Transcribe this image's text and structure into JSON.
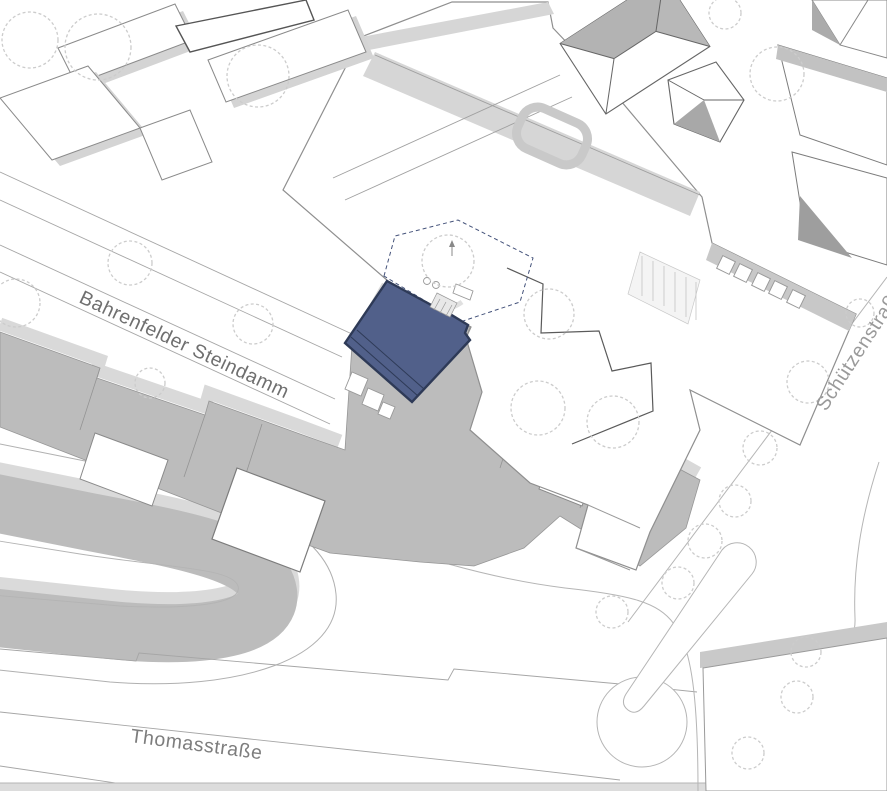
{
  "plan": {
    "type": "architectural-site-plan",
    "labels": {
      "street_upper": "Bahrenfelder Steindamm",
      "street_lower": "Thomasstraße",
      "street_right": "Schützenstraße"
    },
    "highlight": {
      "name": "project-site-building",
      "fill": "#51608a",
      "stroke": "#2e3a57"
    },
    "palette": {
      "background": "#ffffff",
      "block_fill": "#bcbcbc",
      "light_strip": "#d9d9d9",
      "building_shadow": "#d6d6d6",
      "outline": "#8a8a8a",
      "dark_outline": "#555555",
      "tree_stroke": "#cccccc",
      "label_upper_color": "#6f6f6f",
      "label_lower_color": "#7d7d7d",
      "label_right_color": "#9a9a9a"
    }
  }
}
